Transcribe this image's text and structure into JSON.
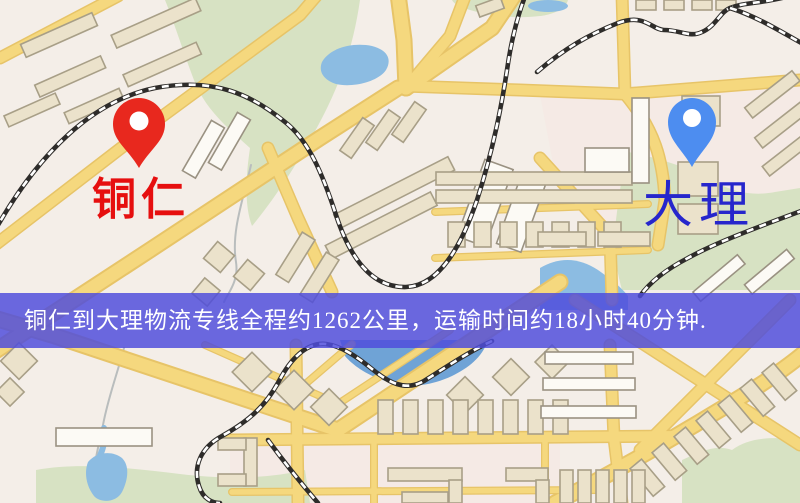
{
  "banner": {
    "text": "铜仁到大理物流专线全程约1262公里，运输时间约18小时40分钟.",
    "background_color": "#4f4cdb",
    "text_color": "#ffffff"
  },
  "markers": {
    "origin": {
      "label": "铜仁",
      "pin_color": "#e8281e",
      "label_color": "#e60f0f"
    },
    "destination": {
      "label": "大理",
      "pin_color": "#4d8df0",
      "label_color": "#2626cc"
    }
  },
  "map": {
    "type": "street-map-illustration",
    "features": [
      "roads",
      "railways",
      "parks",
      "lakes",
      "buildings"
    ]
  },
  "css_vars": {
    "banner-bg": "#4f4cdb",
    "banner-text": "#ffffff",
    "origin-pin": "#e8281e",
    "origin-label": "#e60f0f",
    "dest-pin": "#4d8df0",
    "dest-label": "#2626cc",
    "map-bg": "#f4eee8",
    "road-fill": "#f5d87e",
    "road-edge": "#e7c468",
    "park": "#d7e2c3",
    "water": "#8cbce2",
    "building": "#ebe2cb",
    "building-edge": "#a89f87",
    "rail": "#2e2c2a"
  }
}
